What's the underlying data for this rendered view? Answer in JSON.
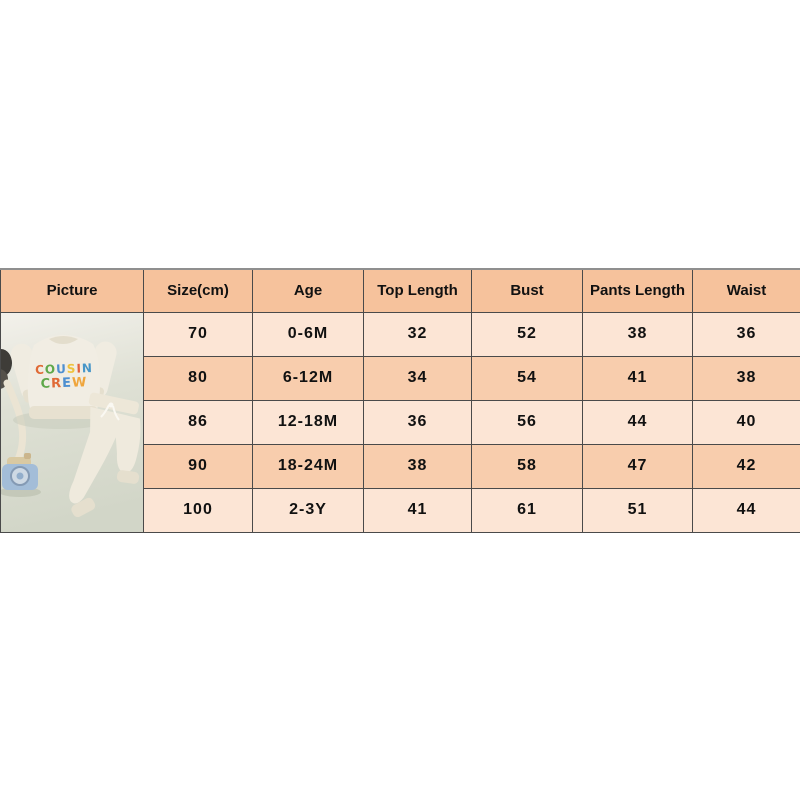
{
  "chart_data": {
    "type": "table",
    "title": "Baby outfit size chart",
    "columns": [
      "Picture",
      "Size(cm)",
      "Age",
      "Top Length",
      "Bust",
      "Pants Length",
      "Waist"
    ],
    "rows": [
      [
        "70",
        "0-6M",
        "32",
        "52",
        "38",
        "36"
      ],
      [
        "80",
        "6-12M",
        "34",
        "54",
        "41",
        "38"
      ],
      [
        "86",
        "12-18M",
        "36",
        "56",
        "44",
        "40"
      ],
      [
        "90",
        "18-24M",
        "38",
        "58",
        "47",
        "42"
      ],
      [
        "100",
        "2-3Y",
        "41",
        "61",
        "51",
        "44"
      ]
    ]
  },
  "photo": {
    "shirt_text_line1": "COUSIN",
    "shirt_text_line2": "CREW",
    "line1_colors": [
      "#e06a36",
      "#5fa84a",
      "#4e8fd0",
      "#efc23c",
      "#e2603c",
      "#4796c8"
    ],
    "line2_colors": [
      "#5fa84a",
      "#e06a36",
      "#4e8fd0",
      "#efa53c"
    ]
  },
  "colors": {
    "header_bg": "#f6c29c",
    "row_light_bg": "#fce5d5",
    "row_dark_bg": "#f8cdad",
    "border": "#4a4a4a",
    "text": "#111111"
  }
}
